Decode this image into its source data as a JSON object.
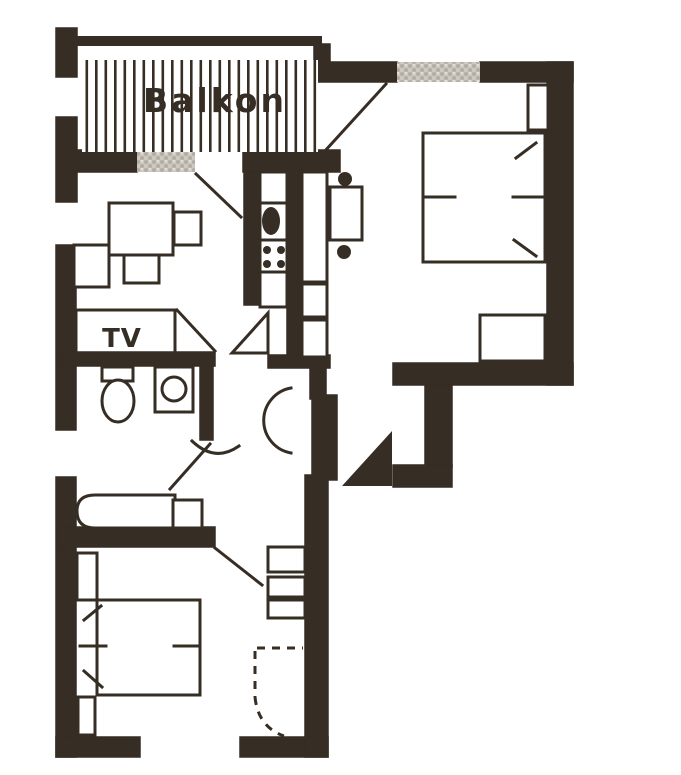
{
  "document": {
    "kind": "scanned apartment floor plan",
    "page_background": "#ffffff"
  },
  "labels": {
    "balcony": "Balkon",
    "tv_unit": "TV"
  },
  "palette": {
    "ink": "#362d25",
    "paper": "#ffffff",
    "window-fill": "#cdc8c0",
    "window-dot": "#b3ada3"
  },
  "symbols": [
    "balcony-railing-hatch",
    "french-window",
    "window",
    "double-bed",
    "bed-pillow-mark",
    "nightstand",
    "dresser",
    "kitchen-counter",
    "kitchen-sink",
    "cooktop-burners",
    "tall-cabinet",
    "dining-table",
    "chair",
    "seating-bench",
    "coffee-table",
    "armchair",
    "tv-shelf",
    "toilet",
    "washing-machine",
    "sofa",
    "side-table",
    "shelf-unit",
    "door-swing-arc",
    "door-leaf",
    "entry-door-leaf-filled",
    "dashed-door-swing"
  ]
}
